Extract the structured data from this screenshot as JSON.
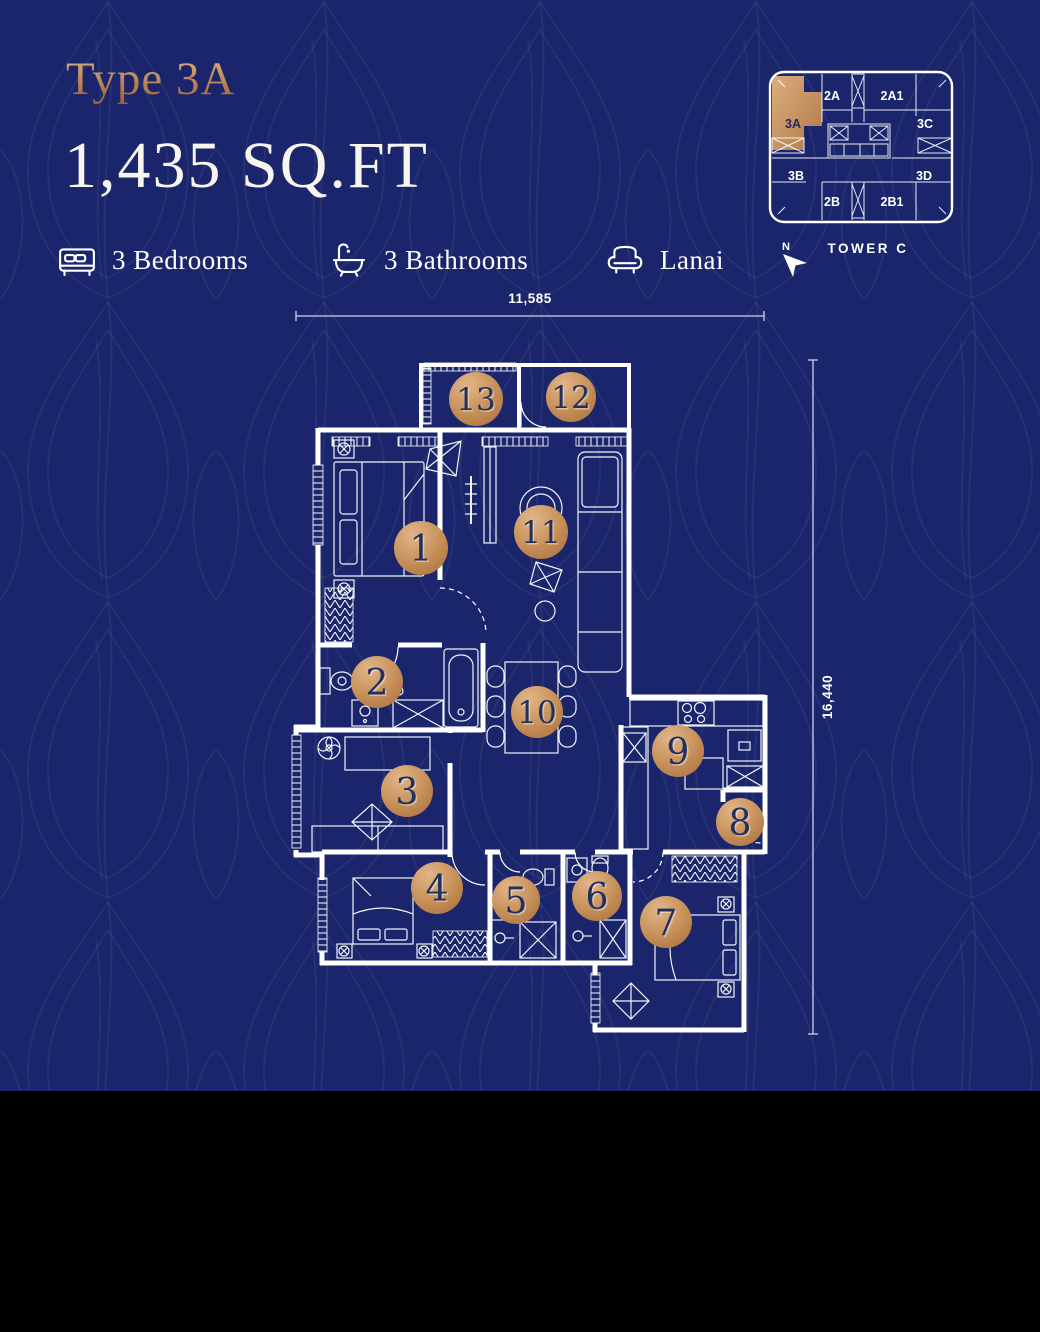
{
  "colors": {
    "background_navy": "#1a256b",
    "pattern_line": "rgba(255,255,255,0.05)",
    "copper_light": "#dfb286",
    "copper_dark": "#a96f3e",
    "line_white": "#ffffff",
    "marker_number_navy": "#22305f",
    "footer_black": "#000000"
  },
  "header": {
    "type_label": "Type 3A",
    "area_label": "1,435 SQ.FT"
  },
  "features": [
    {
      "icon": "bed-icon",
      "label": "3 Bedrooms"
    },
    {
      "icon": "bathtub-icon",
      "label": "3 Bathrooms"
    },
    {
      "icon": "sofa-icon",
      "label": "Lanai"
    }
  ],
  "keyplan": {
    "tower_label": "TOWER C",
    "north_label": "N",
    "highlight_unit": "3A",
    "units": [
      {
        "label": "2A",
        "x": 66,
        "y": 34,
        "highlighted": false
      },
      {
        "label": "2A1",
        "x": 126,
        "y": 34,
        "highlighted": false
      },
      {
        "label": "3C",
        "x": 159,
        "y": 62,
        "highlighted": false
      },
      {
        "label": "3A",
        "x": 27,
        "y": 62,
        "highlighted": true
      },
      {
        "label": "3B",
        "x": 30,
        "y": 114,
        "highlighted": false
      },
      {
        "label": "3D",
        "x": 158,
        "y": 114,
        "highlighted": false
      },
      {
        "label": "2B",
        "x": 66,
        "y": 140,
        "highlighted": false
      },
      {
        "label": "2B1",
        "x": 126,
        "y": 140,
        "highlighted": false
      }
    ]
  },
  "dimensions": {
    "width_label": "11,585",
    "height_label": "16,440"
  },
  "plan": {
    "markers": [
      {
        "n": "1",
        "x": 421,
        "y": 548,
        "r": 27
      },
      {
        "n": "2",
        "x": 377,
        "y": 682,
        "r": 26
      },
      {
        "n": "3",
        "x": 407,
        "y": 791,
        "r": 26
      },
      {
        "n": "4",
        "x": 437,
        "y": 888,
        "r": 26
      },
      {
        "n": "5",
        "x": 516,
        "y": 900,
        "r": 24
      },
      {
        "n": "6",
        "x": 597,
        "y": 896,
        "r": 25
      },
      {
        "n": "7",
        "x": 666,
        "y": 922,
        "r": 26
      },
      {
        "n": "8",
        "x": 740,
        "y": 822,
        "r": 24
      },
      {
        "n": "9",
        "x": 678,
        "y": 751,
        "r": 26
      },
      {
        "n": "10",
        "x": 537,
        "y": 712,
        "r": 26
      },
      {
        "n": "11",
        "x": 541,
        "y": 532,
        "r": 27
      },
      {
        "n": "12",
        "x": 571,
        "y": 397,
        "r": 25
      },
      {
        "n": "13",
        "x": 476,
        "y": 399,
        "r": 27
      }
    ]
  }
}
